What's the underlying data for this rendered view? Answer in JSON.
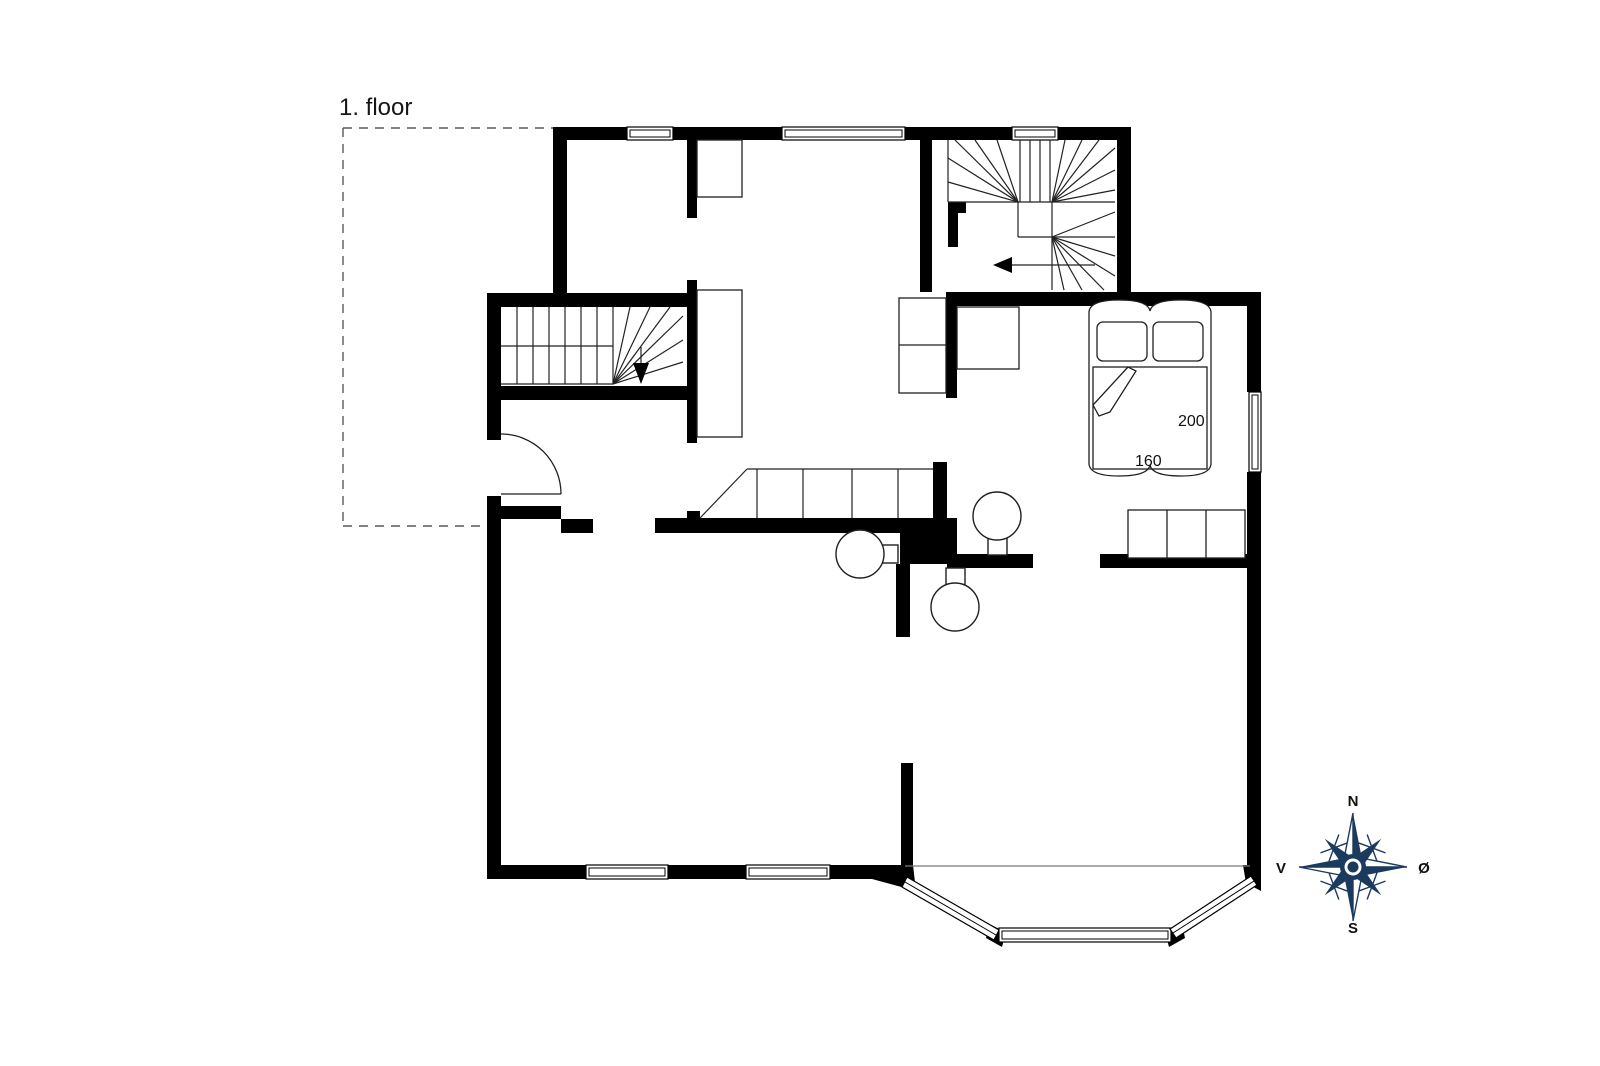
{
  "page": {
    "background": "#ffffff",
    "line_color": "#000000"
  },
  "floor_plan": {
    "floor_label": "1. floor",
    "bed": {
      "length": "200",
      "width": "160"
    },
    "compass": {
      "north": "N",
      "east": "Ø",
      "south": "S",
      "west": "V",
      "color": "#1b3a5e",
      "label_color": "#111111"
    }
  }
}
